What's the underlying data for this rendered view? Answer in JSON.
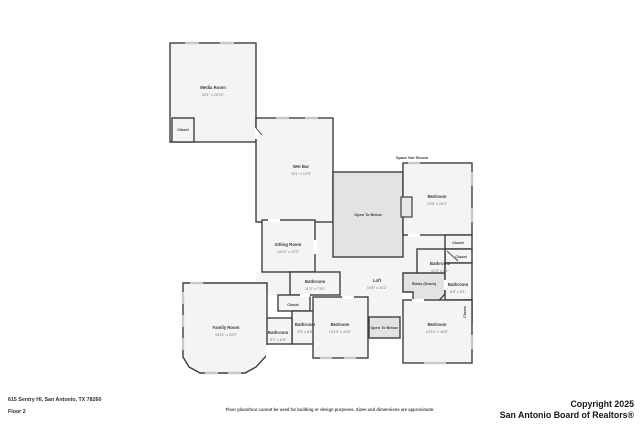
{
  "plan": {
    "space_not_shown_label": "Space Not Shown",
    "rooms": {
      "media": {
        "name": "Media Room",
        "dims": "20'1\" x 20'10\""
      },
      "media_closet": {
        "name": "Closet"
      },
      "wet_bar": {
        "name": "Wet Bar",
        "dims": "16'1\" x 13'3\""
      },
      "open_below_top": {
        "name": "Open To Below"
      },
      "bedroom_tr": {
        "name": "Bedroom",
        "dims": "13'8\" x 16'4\""
      },
      "closet_tr1": {
        "name": "Closet"
      },
      "closet_tr2": {
        "name": "Closet"
      },
      "bathroom_tr": {
        "name": "Bathroom",
        "dims": "11'9\" x 8'1\""
      },
      "sitting": {
        "name": "Sitting Room",
        "dims": "13'10\" x 13'3\""
      },
      "loft": {
        "name": "Loft",
        "dims": "19'8\" x 24'2\""
      },
      "stairs": {
        "name": "Stairs (Down)"
      },
      "bathroom_rm": {
        "name": "Bathroom",
        "dims": "8'6\" x 6'1\""
      },
      "closet_vert": {
        "name": "Closet"
      },
      "bathroom_cu": {
        "name": "Bathroom",
        "dims": "11'3\" x 7'10\""
      },
      "closet_c": {
        "name": "Closet"
      },
      "bathroom_cs": {
        "name": "Bathroom",
        "dims": "4'5\" x 8'5\""
      },
      "bathroom_ls": {
        "name": "Bathroom",
        "dims": "8'1\" x 8'5\""
      },
      "family": {
        "name": "Family Room",
        "dims": "19'11\" x 23'9\""
      },
      "bedroom_bc": {
        "name": "Bedroom",
        "dims": "13'10\" x 14'6\""
      },
      "open_below_bot": {
        "name": "Open To Below"
      },
      "bedroom_br": {
        "name": "Bedroom",
        "dims": "13'10\" x 16'5\""
      }
    }
  },
  "footer": {
    "address": "615 Sentry Hl, San Antonio, TX 78260",
    "floor": "Floor 2",
    "disclaimer": "Floor plans/tour cannot be used for building or design purposes. Sizes and dimensions are approximate.",
    "copyright_line1": "Copyright 2025",
    "copyright_line2": "San Antonio Board of Realtors®"
  },
  "colors": {
    "wall": "#3f3f3f",
    "room_fill": "#f4f4f4",
    "open_area_fill": "#e3e3e3",
    "window": "#c9c9c9",
    "label_text": "#3a3a3a",
    "dims_text": "#757575"
  }
}
